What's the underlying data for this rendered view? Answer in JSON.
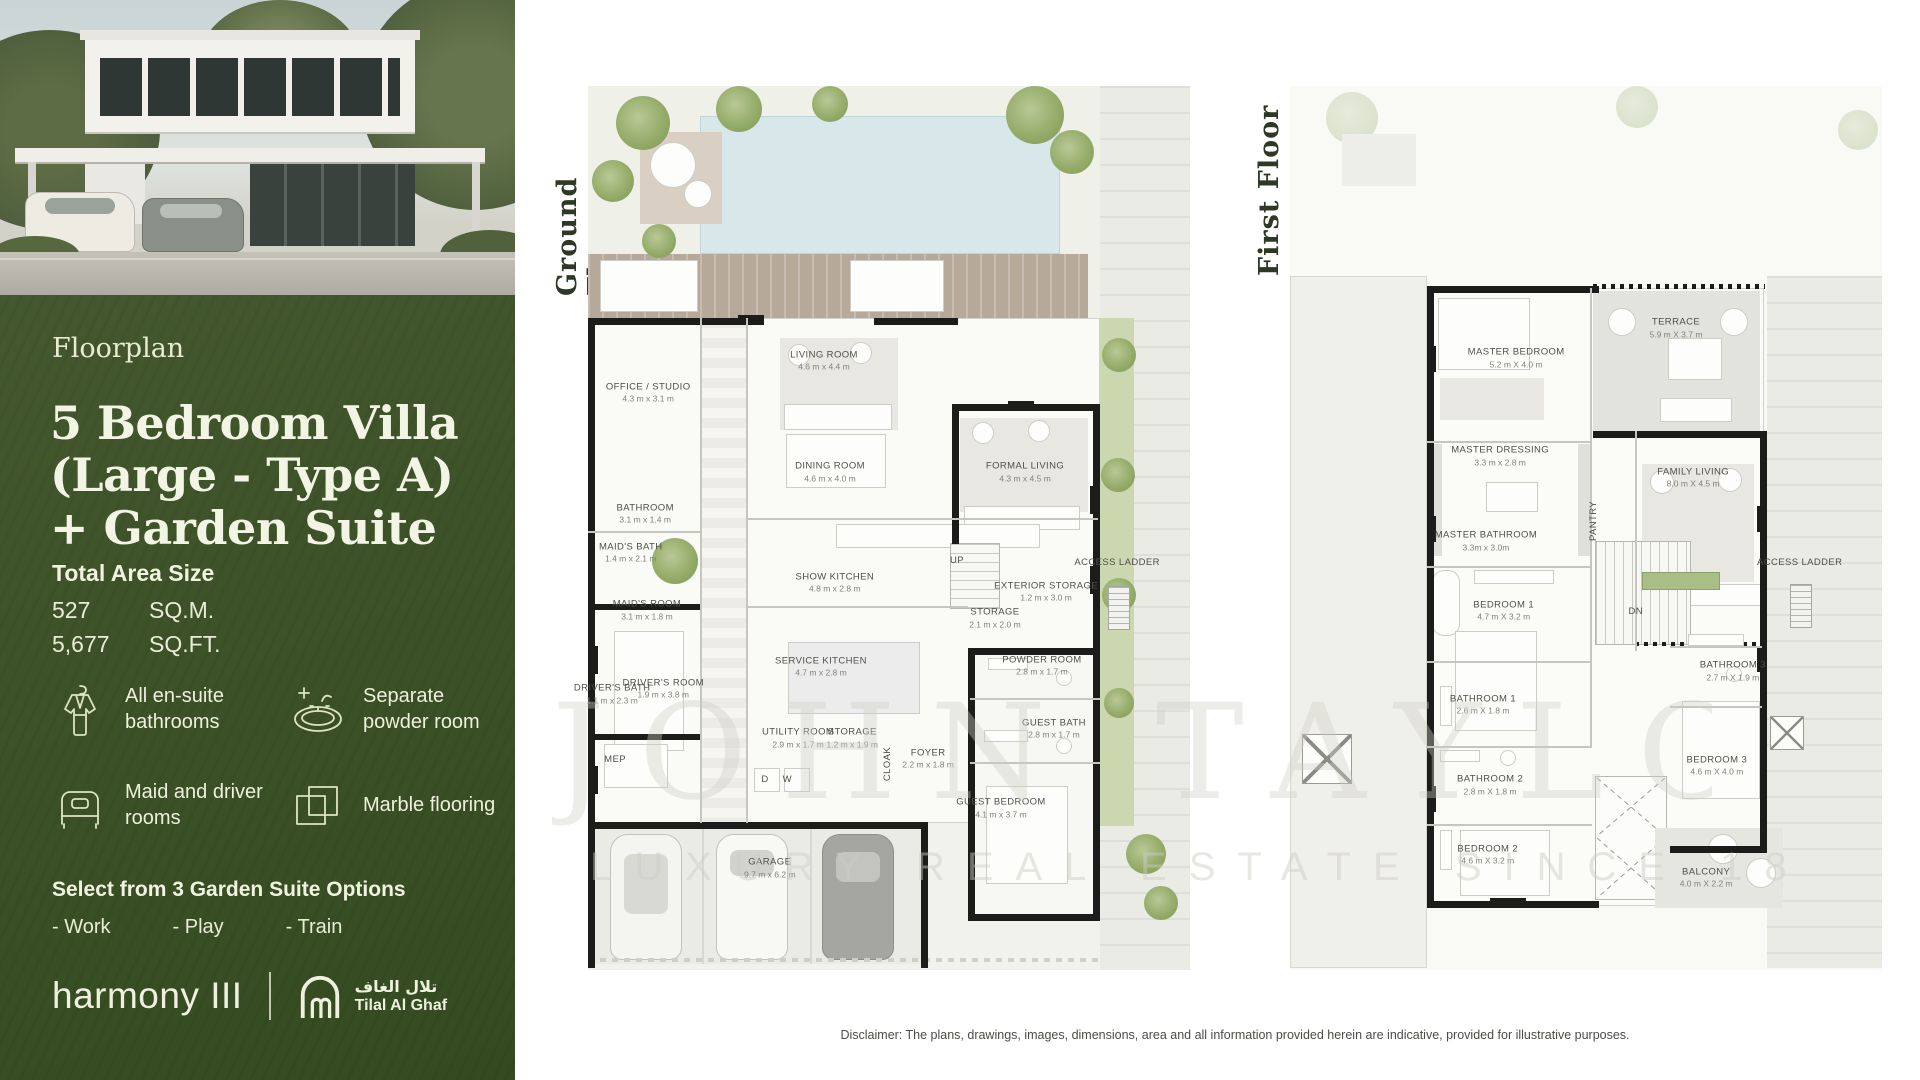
{
  "left_panel": {
    "eyebrow": "Floorplan",
    "title_lines": [
      "5 Bedroom Villa",
      "(Large - Type A)",
      "+ Garden Suite"
    ],
    "total_area": {
      "heading": "Total Area Size",
      "rows": [
        {
          "value": "527",
          "unit": "SQ.M."
        },
        {
          "value": "5,677",
          "unit": "SQ.FT."
        }
      ]
    },
    "features": [
      {
        "icon": "bathrobe-icon",
        "label": "All en-suite bathrooms"
      },
      {
        "icon": "sink-icon",
        "label": "Separate powder room"
      },
      {
        "icon": "bed-icon",
        "label": "Maid and driver rooms"
      },
      {
        "icon": "marble-tiles-icon",
        "label": "Marble flooring"
      }
    ],
    "garden_suite": {
      "heading": "Select from 3 Garden Suite Options",
      "options": [
        "- Work",
        "- Play",
        "- Train"
      ]
    },
    "brand": {
      "wordmark": "harmony III",
      "developer_arabic": "تلال الغاف",
      "developer_latin": "Tilal Al Ghaf"
    },
    "accent_green": "#41552c",
    "text_cream": "#f2f4e4"
  },
  "ground_floor": {
    "label": "Ground Floor",
    "rooms": [
      {
        "name": "OFFICE / STUDIO",
        "dims": "4.3 m x 3.1 m",
        "x": 10.0,
        "y": 34.7
      },
      {
        "name": "LIVING ROOM",
        "dims": "4.6 m x 4.4 m",
        "x": 39.2,
        "y": 31.1
      },
      {
        "name": "DINING ROOM",
        "dims": "4.6 m x 4.0 m",
        "x": 40.2,
        "y": 43.7
      },
      {
        "name": "FORMAL LIVING",
        "dims": "4.3 m x 4.5 m",
        "x": 72.6,
        "y": 43.7
      },
      {
        "name": "BATHROOM",
        "dims": "3.1 m x 1.4 m",
        "x": 9.5,
        "y": 48.4
      },
      {
        "name": "MAID'S BATH",
        "dims": "1.4 m x 2.1 m",
        "x": 7.1,
        "y": 52.8
      },
      {
        "name": "MAID'S ROOM",
        "dims": "3.1 m x 1.8 m",
        "x": 9.8,
        "y": 59.3
      },
      {
        "name": "SHOW KITCHEN",
        "dims": "4.8 m x 2.8 m",
        "x": 41.0,
        "y": 56.2
      },
      {
        "name": "DRIVER'S BATH",
        "dims": "1.1 m x 2.3 m",
        "x": 4.0,
        "y": 68.8
      },
      {
        "name": "DRIVER'S ROOM",
        "dims": "1.9 m x 3.8 m",
        "x": 12.5,
        "y": 68.2
      },
      {
        "name": "SERVICE KITCHEN",
        "dims": "4.7 m x 2.8 m",
        "x": 38.7,
        "y": 65.7
      },
      {
        "name": "UTILITY ROOM",
        "dims": "2.9 m x 1.7 m",
        "x": 34.9,
        "y": 73.8
      },
      {
        "name": "STORAGE",
        "dims": "1.2 m x 1.9 m",
        "x": 43.9,
        "y": 73.8
      },
      {
        "name": "FOYER",
        "dims": "2.2 m x 1.8 m",
        "x": 56.5,
        "y": 76.1
      },
      {
        "name": "STORAGE",
        "dims": "2.1 m x 2.0 m",
        "x": 67.6,
        "y": 60.2
      },
      {
        "name": "EXTERIOR STORAGE",
        "dims": "1.2 m x 3.0 m",
        "x": 76.1,
        "y": 57.2
      },
      {
        "name": "ACCESS LADDER",
        "x": 87.9,
        "y": 54.0
      },
      {
        "name": "POWDER ROOM",
        "dims": "2.8 m x 1.7 m",
        "x": 75.4,
        "y": 65.6
      },
      {
        "name": "GUEST BATH",
        "dims": "2.8 m x 1.7 m",
        "x": 77.4,
        "y": 72.7
      },
      {
        "name": "GUEST BEDROOM",
        "dims": "4.1 m x 3.7 m",
        "x": 68.6,
        "y": 81.7
      },
      {
        "name": "GARAGE",
        "dims": "9.7 m x 6.2 m",
        "x": 30.2,
        "y": 88.5
      }
    ],
    "annotations": [
      {
        "text": "UP",
        "x": 61.3,
        "y": 53.7
      },
      {
        "text": "MEP",
        "x": 4.5,
        "y": 76.2
      },
      {
        "text": "CLOAK",
        "x": 49.8,
        "y": 76.7,
        "vertical": true
      },
      {
        "text": "D",
        "x": 29.4,
        "y": 78.5
      },
      {
        "text": "W",
        "x": 33.1,
        "y": 78.5
      }
    ]
  },
  "first_floor": {
    "label": "First Floor",
    "rooms": [
      {
        "name": "MASTER BEDROOM",
        "dims": "5.2 m X 4.0 m",
        "x": 38.2,
        "y": 30.8
      },
      {
        "name": "TERRACE",
        "dims": "5.9 m X 3.7 m",
        "x": 65.2,
        "y": 27.4
      },
      {
        "name": "MASTER DRESSING",
        "dims": "3.3 m x 2.8 m",
        "x": 35.5,
        "y": 41.9
      },
      {
        "name": "MASTER BATHROOM",
        "dims": "3.3m x 3.0m",
        "x": 33.1,
        "y": 51.5
      },
      {
        "name": "FAMILY LIVING",
        "dims": "8.0 m X 4.5 m",
        "x": 68.1,
        "y": 44.3
      },
      {
        "name": "BEDROOM 1",
        "dims": "4.7 m X 3.2 m",
        "x": 36.1,
        "y": 59.4
      },
      {
        "name": "BATHROOM 1",
        "dims": "2.6 m X 1.8 m",
        "x": 32.6,
        "y": 70.0
      },
      {
        "name": "BATHROOM 2",
        "dims": "2.8 m X 1.8 m",
        "x": 33.8,
        "y": 79.1
      },
      {
        "name": "BEDROOM 2",
        "dims": "4.6 m X 3.2 m",
        "x": 33.4,
        "y": 87.0
      },
      {
        "name": "BATHROOM 3",
        "dims": "2.7 m X 1.9 m",
        "x": 74.8,
        "y": 66.2
      },
      {
        "name": "BEDROOM 3",
        "dims": "4.6 m X 4.0 m",
        "x": 72.1,
        "y": 76.9
      },
      {
        "name": "BALCONY",
        "dims": "4.0 m X 2.2 m",
        "x": 70.3,
        "y": 89.6
      },
      {
        "name": "ACCESS LADDER",
        "x": 86.1,
        "y": 54.0
      }
    ],
    "annotations": [
      {
        "text": "PANTRY",
        "x": 51.4,
        "y": 49.2,
        "vertical": true
      },
      {
        "text": "DN",
        "x": 58.4,
        "y": 59.5
      }
    ]
  },
  "watermark": {
    "line1": "JOHN TAYLOR",
    "line2": "LUXURY REAL ESTATE SINCE 18"
  },
  "disclaimer": "Disclaimer: The plans, drawings, images, dimensions, area and all information provided herein are indicative, provided for illustrative purposes."
}
